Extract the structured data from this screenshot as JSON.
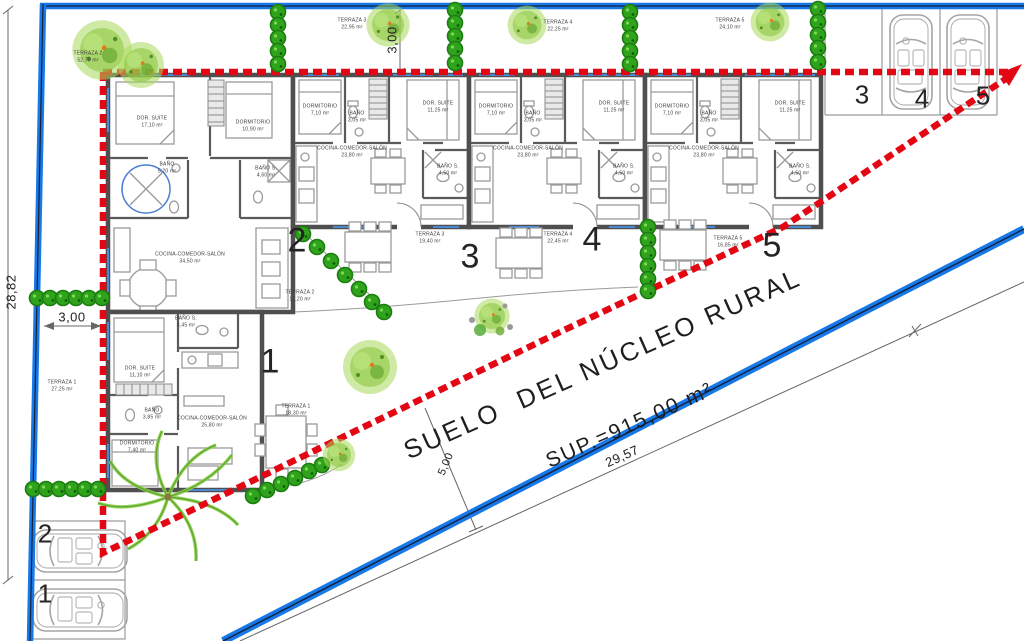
{
  "plan": {
    "zone_text": {
      "line1": "SUELO  DEL NÚCLEO RURAL",
      "line2": "SUP.=915,00 m²"
    },
    "dimensions": {
      "west_total": "28,82",
      "west_setback": "3,00",
      "north_setback": "3,00",
      "south_setback": "5,00",
      "road_length": "29,57"
    },
    "unit_numbers": {
      "n1": "1",
      "n2": "2",
      "n3": "3",
      "n4": "4",
      "n5": "5"
    },
    "parking": {
      "top": {
        "s3": "3",
        "s4": "4",
        "s5": "5"
      },
      "bottom": {
        "s2": "2",
        "s1": "1"
      }
    },
    "terraces": {
      "north": [
        {
          "name": "TERRAZA 2",
          "area": "52,70 m²"
        },
        {
          "name": "TERRAZA 3",
          "area": "22,95 m²"
        },
        {
          "name": "TERRAZA 4",
          "area": "22,25 m²"
        },
        {
          "name": "TERRAZA 5",
          "area": "24,10 m²"
        }
      ],
      "south": [
        {
          "name": "TERRAZA 1",
          "area": "27,25 m²"
        },
        {
          "name": "TERRAZA 1",
          "area": "18,30 m²"
        },
        {
          "name": "TERRAZA 2",
          "area": "17,20 m²"
        },
        {
          "name": "TERRAZA 3",
          "area": "19,40 m²"
        },
        {
          "name": "TERRAZA 4",
          "area": "22,45 m²"
        },
        {
          "name": "TERRAZA 5",
          "area": "16,85 m²"
        }
      ]
    },
    "rooms": {
      "unit2": [
        {
          "name": "DOR. SUITE",
          "area": "17,10 m²"
        },
        {
          "name": "DORMITORIO",
          "area": "10,90 m²"
        },
        {
          "name": "BAÑO",
          "area": "5,20 m²"
        },
        {
          "name": "BAÑO S.",
          "area": "4,60 m²"
        },
        {
          "name": "COCINA-COMEDOR-SALÓN",
          "area": "34,50 m²"
        }
      ],
      "unit1": [
        {
          "name": "BAÑO S.",
          "area": "4,45 m²"
        },
        {
          "name": "DOR. SUITE",
          "area": "11,10 m²"
        },
        {
          "name": "BAÑO",
          "area": "3,85 m²"
        },
        {
          "name": "DORMITORIO",
          "area": "7,40 m²"
        },
        {
          "name": "COCINA-COMEDOR-SALÓN",
          "area": "25,80 m²"
        }
      ],
      "row_unit": [
        {
          "name": "DORMITORIO",
          "area": "7,10 m²"
        },
        {
          "name": "BAÑO",
          "area": "3,05 m²"
        },
        {
          "name": "DOR. SUITE",
          "area": "11,25 m²"
        },
        {
          "name": "COCINA-COMEDOR-SALÓN",
          "area": "23,80 m²"
        },
        {
          "name": "BAÑO S.",
          "area": "4,50 m²"
        }
      ]
    },
    "colors": {
      "boundary_red": "#e30613",
      "road_blue": "#1778e8",
      "wall_gray": "#4f4f4f",
      "tree_green": "#8cc63f",
      "hedge_green": "#2fa31c"
    }
  }
}
